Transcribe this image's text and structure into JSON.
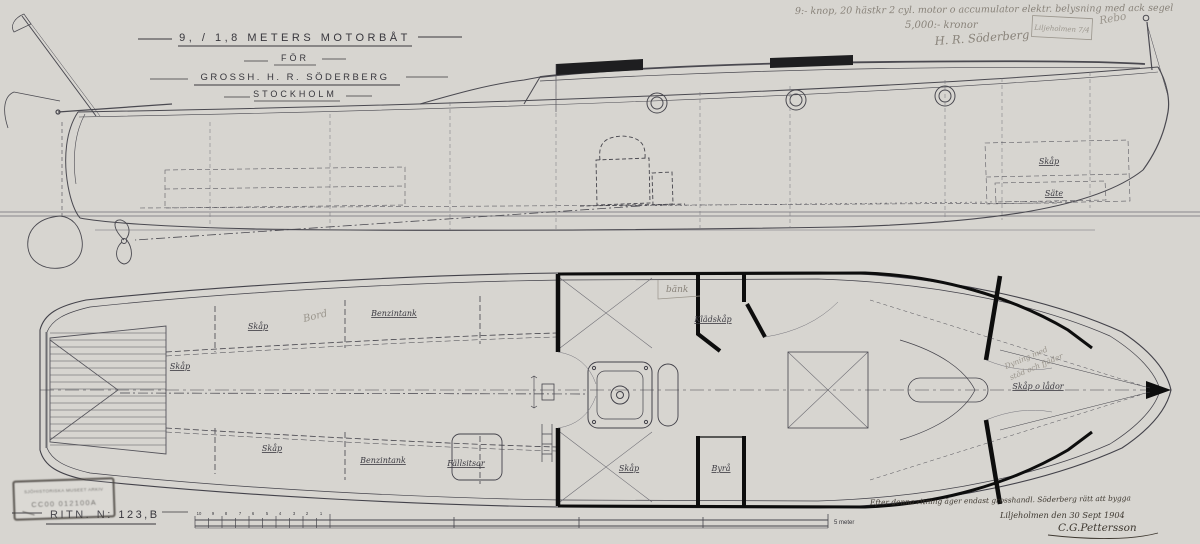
{
  "title_block": {
    "line1": "9, / 1,8 METERS MOTORBÅT",
    "line2": "FÖR",
    "line3": "GROSSH. H. R. SÖDERBERG",
    "line4": "STOCKHOLM"
  },
  "pencil_notes": {
    "spec_line": "9:- knop, 20 hästkr 2 cyl. motor o accumulator elektr. belysning med ack segel",
    "price_line": "5,000:- kronor",
    "signature": "H. R. Söderberg",
    "box_note": "Liljeholmen 7/4",
    "side_note": "Rebo",
    "bench_note": "bänk",
    "table_note": "Bord",
    "berth_note_line1": "Dyning med",
    "berth_note_line2": "stöd och fjäder"
  },
  "ink_notes": {
    "rights_line": "Efter denna ritning äger endast grosshandl. Söderberg rätt att bygga",
    "place_date": "Liljeholmen den 30 Sept 1904",
    "signature": "C.G.Pettersson"
  },
  "footer": {
    "drawing_number": "RITN. N: 123,B",
    "scale_unit_label": "5 meter",
    "scale_ticks": [
      "10",
      "9",
      "8",
      "7",
      "6",
      "5",
      "4",
      "3",
      "2",
      "1"
    ]
  },
  "archive_stamp": {
    "line1": "SJÖHISTORISKA MUSEET ARKIV",
    "line2": "CC00 012100A"
  },
  "plan_labels": [
    {
      "text": "Skåp"
    },
    {
      "text": "Skåp"
    },
    {
      "text": "Benzintank"
    },
    {
      "text": "Skåp"
    },
    {
      "text": "Benzintank"
    },
    {
      "text": "Fällsitsar"
    },
    {
      "text": "Skåp"
    },
    {
      "text": "Byrå"
    },
    {
      "text": "Klädskåp"
    },
    {
      "text": "Skåp o lådor"
    }
  ],
  "profile_labels": [
    {
      "text": "Skåp"
    },
    {
      "text": "Säte"
    }
  ],
  "colors": {
    "paper": "#d7d5d0",
    "ink_line": "#4a4950",
    "heavy_line": "#101010",
    "pencil": "#89837a",
    "edge_warm": "#e8ddc2"
  }
}
